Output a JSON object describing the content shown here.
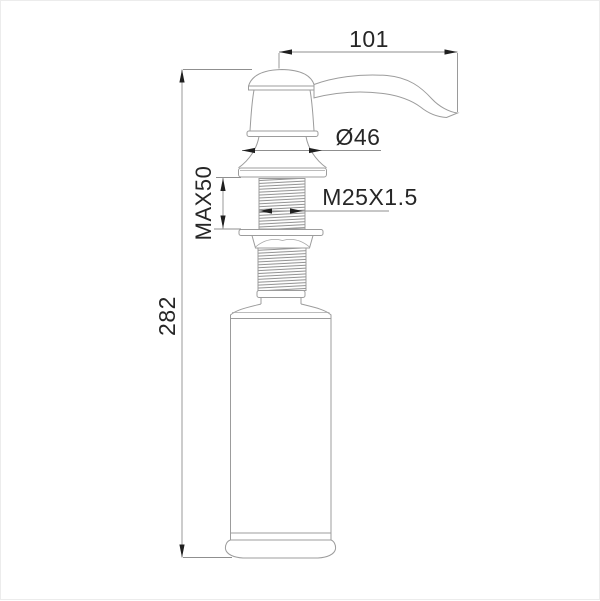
{
  "page": {
    "background": "#ffffff",
    "frame_border": "#ececec"
  },
  "drawing": {
    "subject": "Soap dispenser technical line drawing, side elevation",
    "colors": {
      "outline": "#9c9c9c",
      "thread_hatch": "#8f8f8f",
      "dimension_line": "#8f8f8f",
      "arrowhead": "#1f1f1f",
      "label_text": "#262626"
    },
    "labels": {
      "spout_reach": "101",
      "head_diameter": "Ø46",
      "max_counter_thickness": "MAX50",
      "thread_spec": "M25X1.5",
      "overall_height": "282"
    }
  }
}
